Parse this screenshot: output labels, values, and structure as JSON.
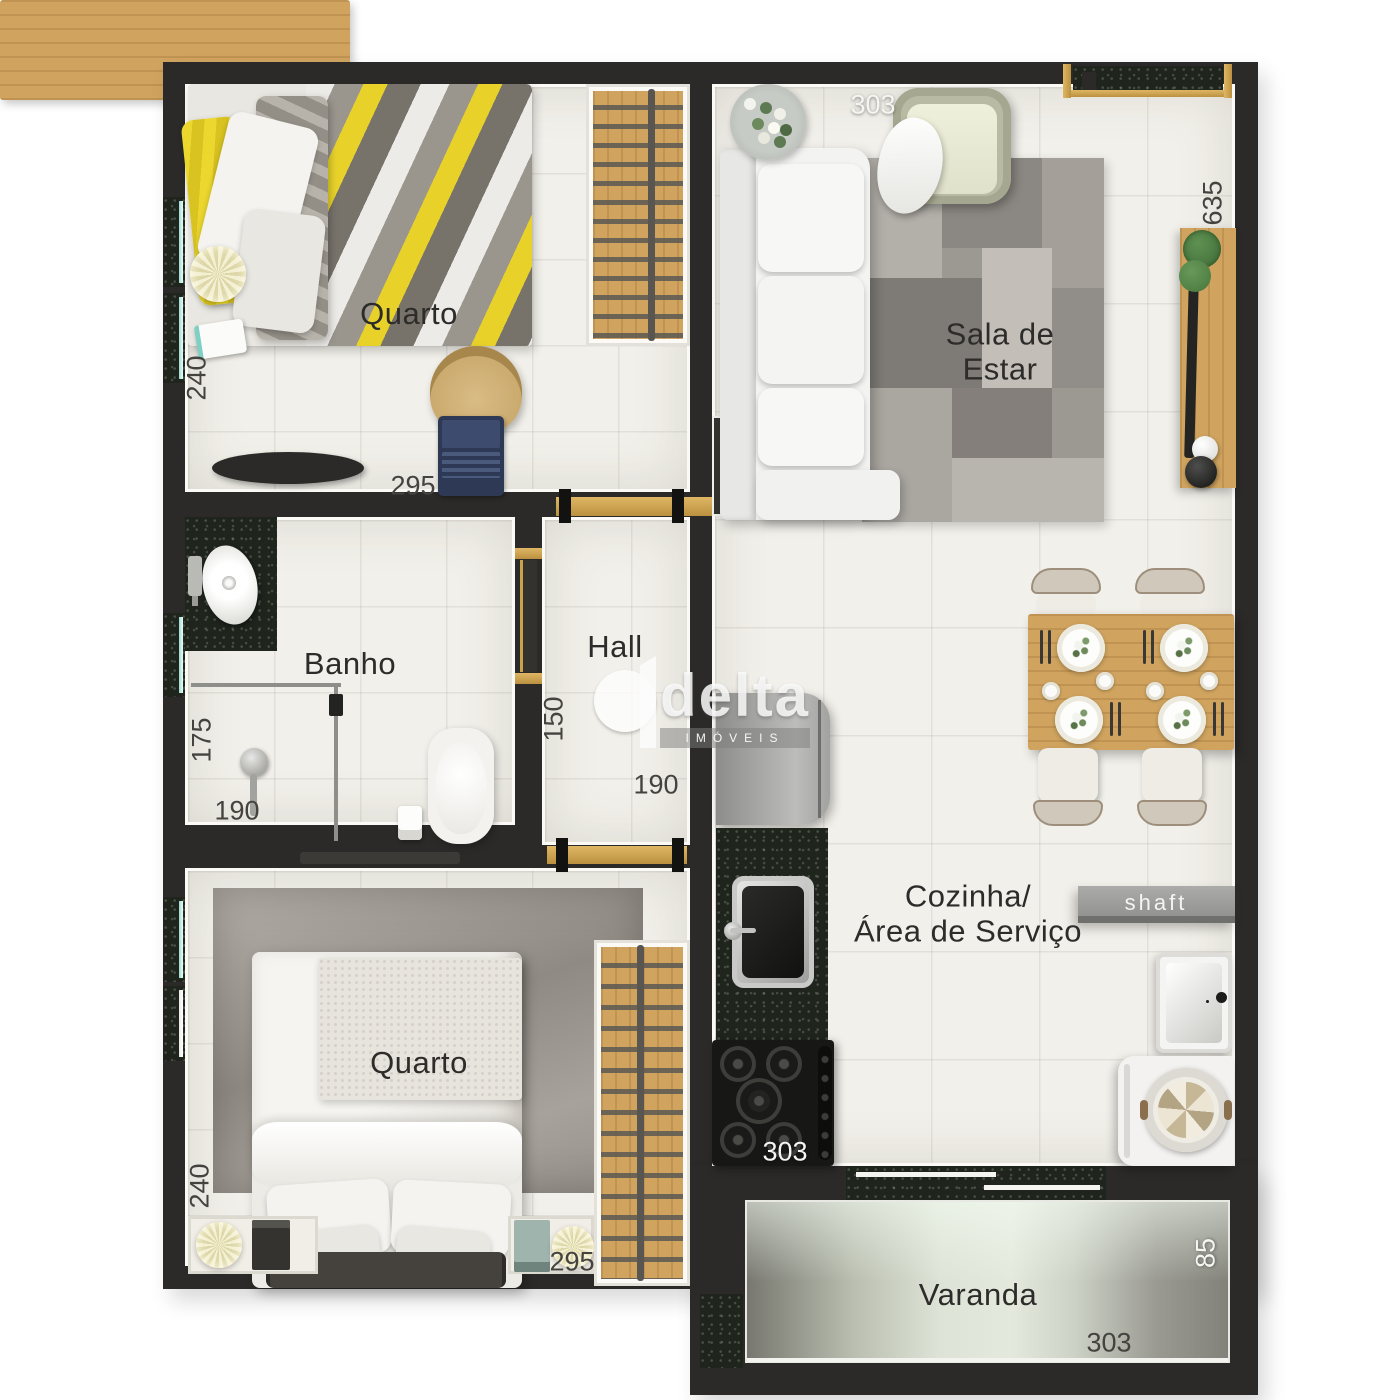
{
  "title": "Planta humanizada de apartamento",
  "watermark": {
    "brand": "delta",
    "tagline": "IMÓVEIS"
  },
  "labels": {
    "bedroom1_label": "Quarto",
    "bedroom2_label": "Quarto",
    "bathroom_label": "Banho",
    "hall_label": "Hall",
    "living_line1": "Sala de",
    "living_line2": "Estar",
    "kitchen_line1": "Cozinha/",
    "kitchen_line2": "Área de Serviço",
    "balcony_label": "Varanda",
    "shaft_label": "shaft"
  },
  "dimensions": {
    "living_top": "303",
    "living_right": "635",
    "bed1_left": "240",
    "bed1_bottom": "295",
    "bath_left": "175",
    "bath_bottom": "190",
    "hall_left": "150",
    "hall_bottom": "190",
    "bed2_left": "240",
    "bed2_bottom": "295",
    "kitchen_bottom": "303",
    "balcony_right": "85",
    "balcony_bottom": "303"
  },
  "colors": {
    "wall": "#2b2a28",
    "floor": "#f2f0ea",
    "gold_frame": "#c8a24d",
    "granite": "#1f241d",
    "wood": "#d0a45f",
    "bed_accent_yellow": "#e8d22a",
    "balcony_glass": "#dde3d6"
  }
}
